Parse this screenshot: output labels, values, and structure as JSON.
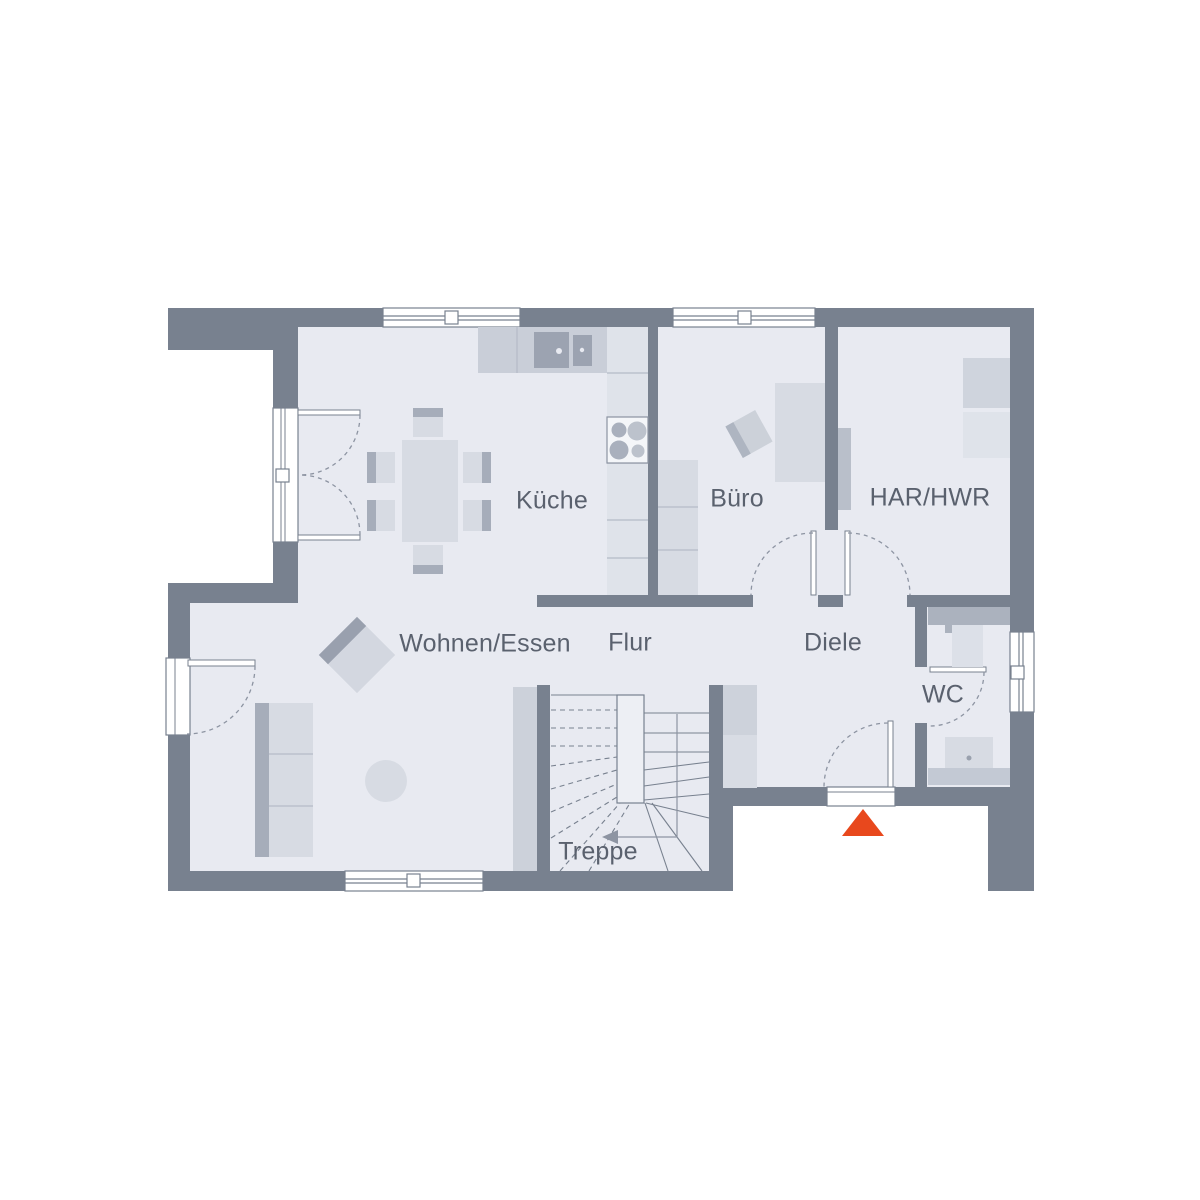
{
  "floorplan": {
    "type": "ground-floor-plan",
    "rooms": {
      "wohnen_essen": {
        "label": "Wohnen/Essen"
      },
      "kueche": {
        "label": "Küche"
      },
      "buero": {
        "label": "Büro"
      },
      "har_hwr": {
        "label": "HAR/HWR"
      },
      "flur": {
        "label": "Flur"
      },
      "diele": {
        "label": "Diele"
      },
      "wc": {
        "label": "WC"
      },
      "treppe": {
        "label": "Treppe"
      }
    },
    "entrance_marker": {
      "shape": "triangle-up",
      "color": "#E8481D"
    },
    "colors": {
      "wall": "#78818F",
      "floor": "#E8EAF1",
      "furniture_light": "#D7DBE3",
      "furniture_medium": "#C7CCD6",
      "furniture_dark": "#A6ADBA",
      "label_text": "#5A616E",
      "background": "#FFFFFF"
    }
  }
}
